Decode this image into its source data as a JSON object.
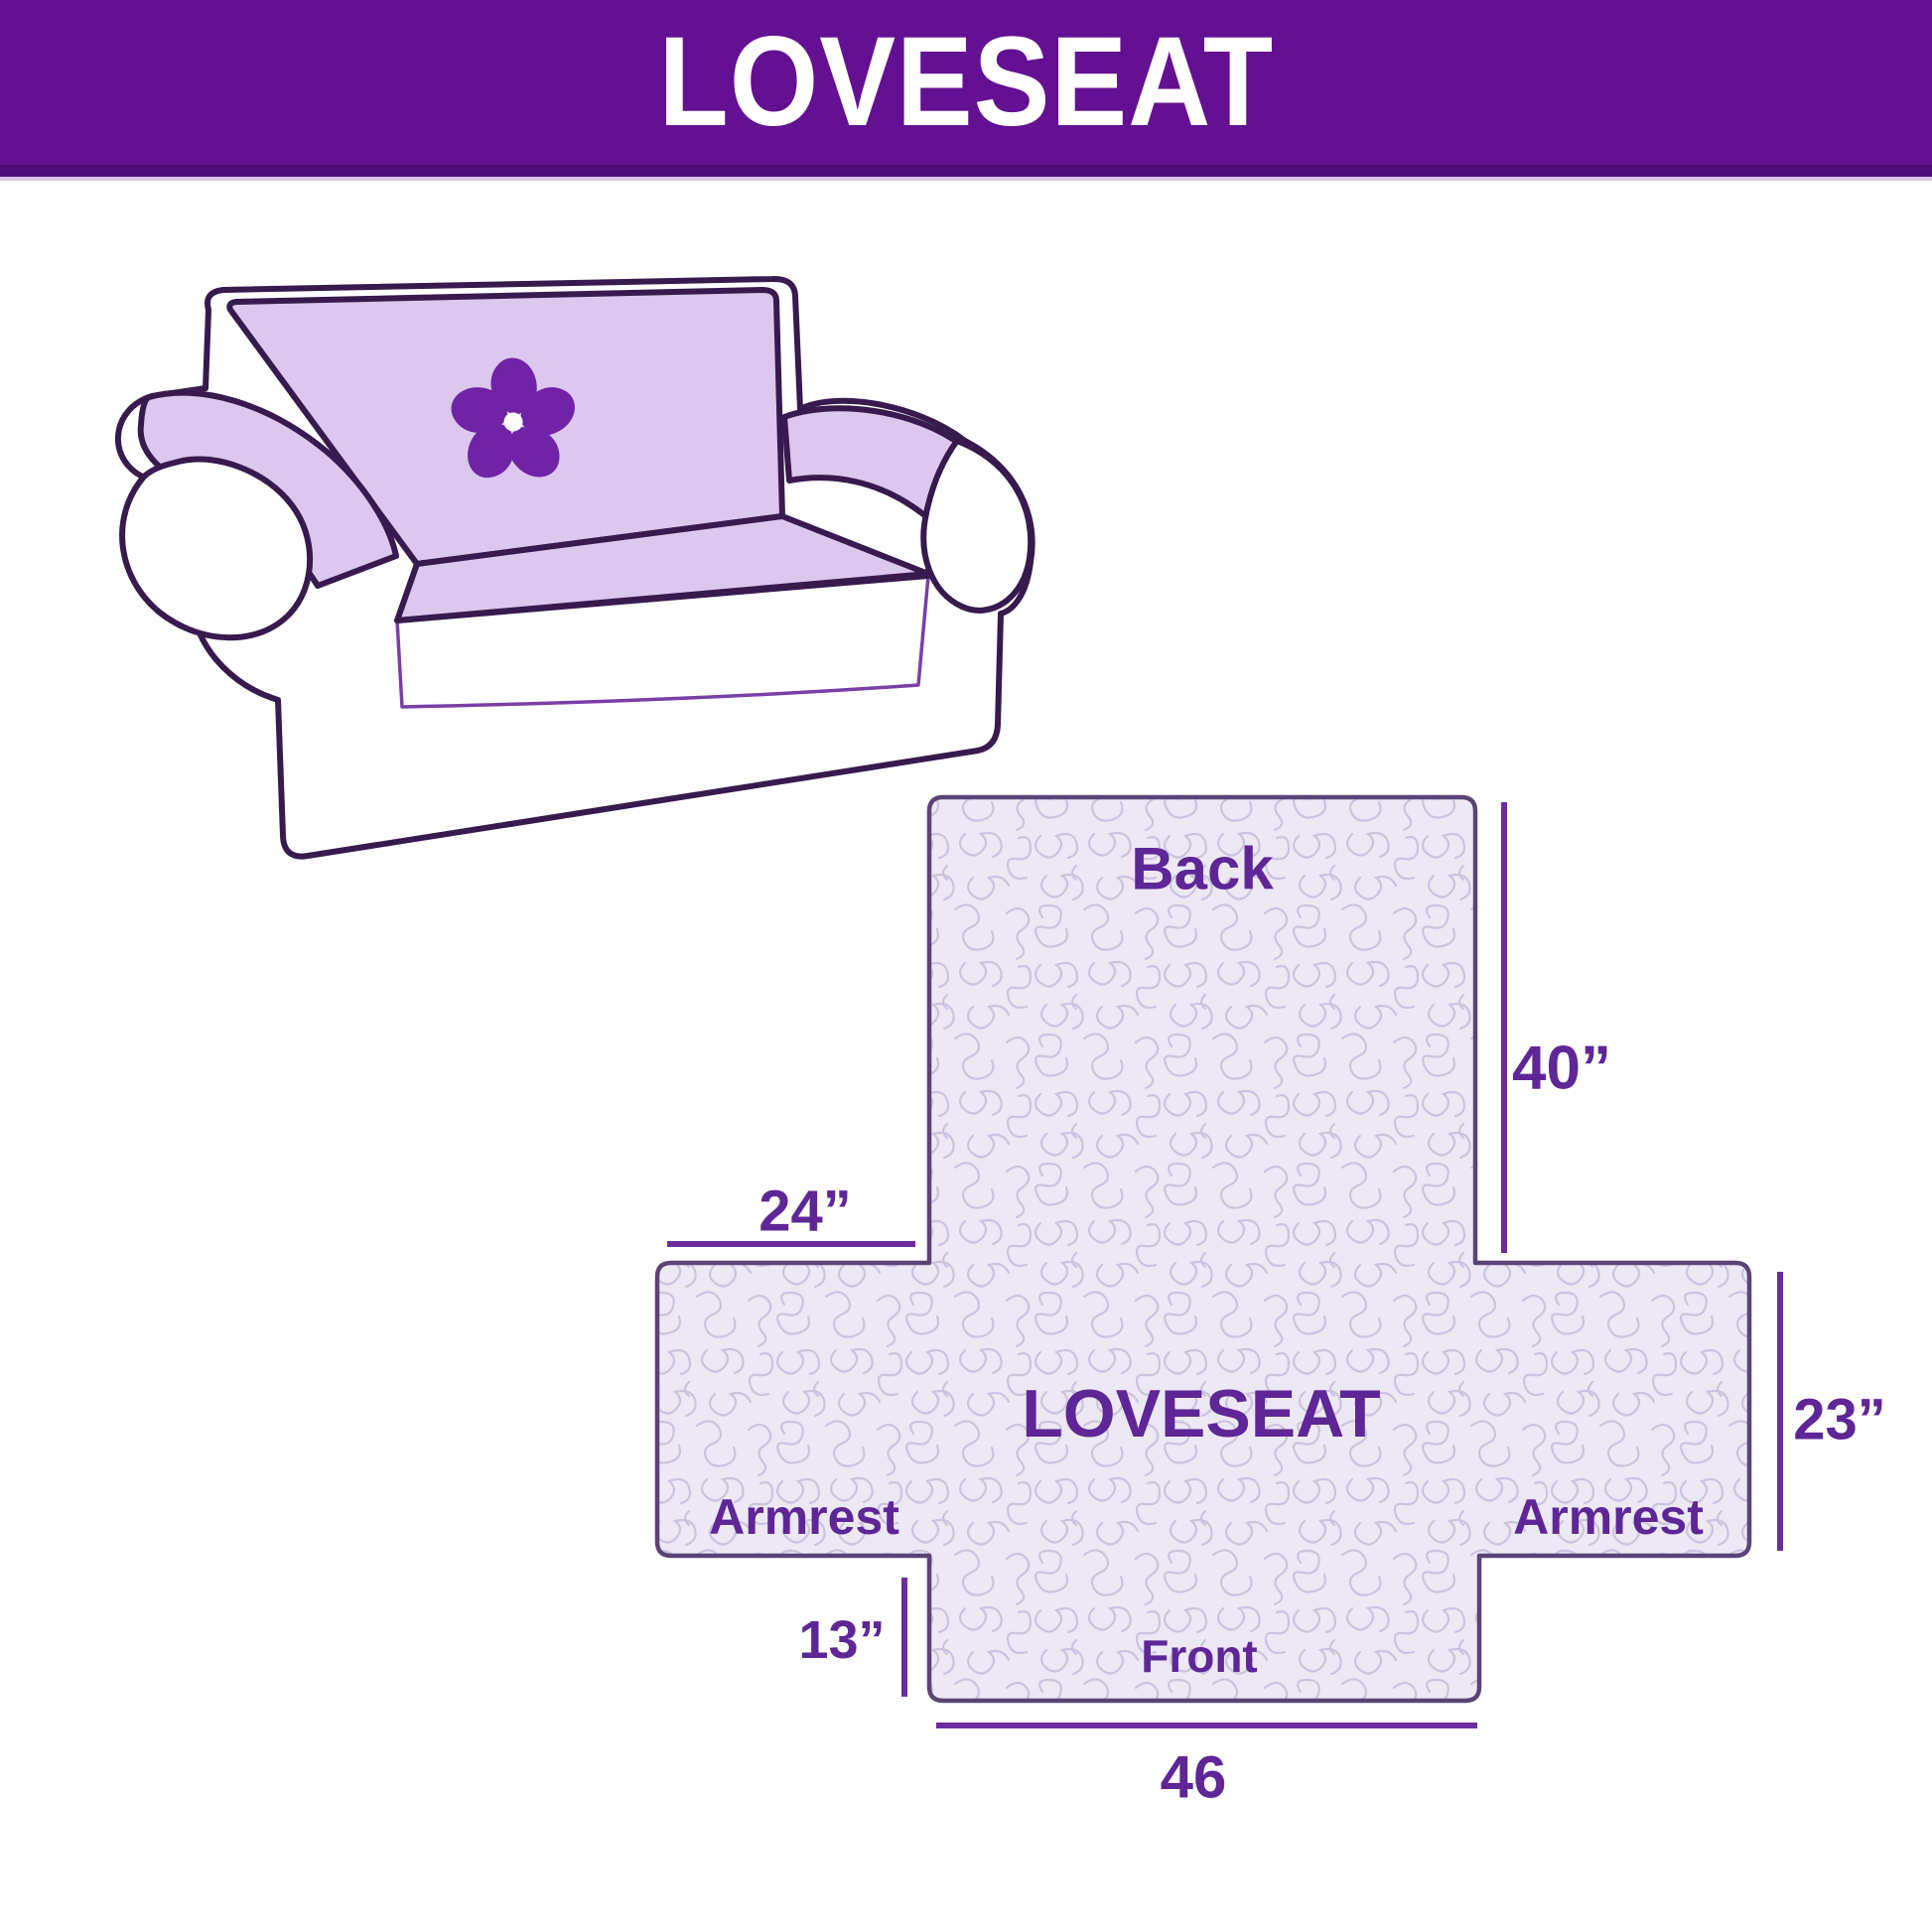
{
  "banner": {
    "title": "LOVESEAT"
  },
  "illustration": {
    "alt": "loveseat with quilted protective cover",
    "logo": "pinwheel"
  },
  "diagram": {
    "center_label": "LOVESEAT",
    "back_label": "Back",
    "front_label": "Front",
    "armrest_left_label": "Armrest",
    "armrest_right_label": "Armrest",
    "dim_back_height": "40”",
    "dim_armrest_top_width": "24”",
    "dim_armrest_side_height": "23”",
    "dim_front_drop": "13”",
    "dim_front_width": "46"
  },
  "colors": {
    "banner_purple": "#631192",
    "banner_dark_strip": "#4F0C78",
    "label_purple": "#5E2697",
    "dimension_line_purple": "#6B2D9E",
    "cover_lavender": "#DCC7EE",
    "logo_purple": "#7123A8",
    "outline_dark": "#371A4E",
    "quilt_background": "#ECE8F4",
    "quilt_stitch": "#CBC1DD",
    "cross_border": "#5A4476"
  }
}
